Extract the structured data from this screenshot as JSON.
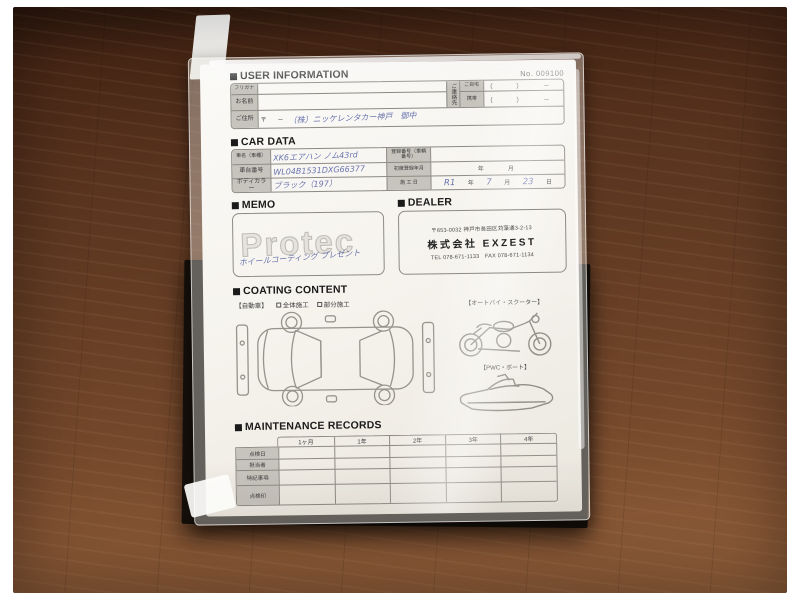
{
  "form": {
    "no": "No. 009100",
    "user_information": {
      "title": "USER INFORMATION",
      "furigana_label": "フリガナ",
      "name_label": "お名前",
      "contact_label": "ご連絡先",
      "home_label": "ご自宅",
      "mobile_label": "携帯",
      "phone_home": "（　　　）　　　－",
      "phone_mobile": "（　　　）　　　－",
      "address_label": "ご住所",
      "postal_mark": "〒",
      "postal_blank": "　－",
      "address_handwritten": "（株）ニッケレンタカー神戸　御中"
    },
    "car_data": {
      "title": "CAR DATA",
      "car_name_label": "車名（車種）",
      "car_name_value": "XK6エアハン ノム43rd",
      "chassis_label": "車台番号",
      "chassis_value": "WL04B1531DXG66377",
      "body_color_label": "ボディカラー",
      "body_color_value": "ブラック（197）",
      "registration_label": "登録番号（車輌番号）",
      "first_registration_label": "初度登録年月",
      "first_registration_units": "年　　月",
      "install_date_label": "施 工 日",
      "install_date_era": "R1",
      "unit_year": "年",
      "install_date_month": "7",
      "unit_month": "月",
      "install_date_day": "23",
      "unit_day": "日"
    },
    "memo": {
      "title": "MEMO",
      "watermark": "Protec",
      "handwritten": "ホイールコーティング プレゼント"
    },
    "dealer": {
      "title": "DEALER",
      "address": "〒653-0032 神戸市長田区苅藻通3-2-13",
      "company": "株式会社 EXZEST",
      "tel_fax": "TEL 078-671-1133　FAX 078-671-1134"
    },
    "coating": {
      "title": "COATING CONTENT",
      "vehicle_label": "【自動車】",
      "full_label": "全体施工",
      "partial_label": "部分施工",
      "motorcycle_label": "【オートバイ・スクーター】",
      "pwc_label": "【PWC・ボート】"
    },
    "maintenance": {
      "title": "MAINTENANCE RECORDS",
      "columns": [
        "1ヶ月",
        "1年",
        "2年",
        "3年",
        "4年"
      ],
      "row_labels": [
        "点検日",
        "担当者",
        "特記事項",
        "点検印"
      ]
    }
  },
  "colors": {
    "handwriting_blue": "#5a66a6",
    "label_cell_gray": "#c7c4be",
    "line_gray": "#8d8a84",
    "folder_black": "#16100b"
  }
}
